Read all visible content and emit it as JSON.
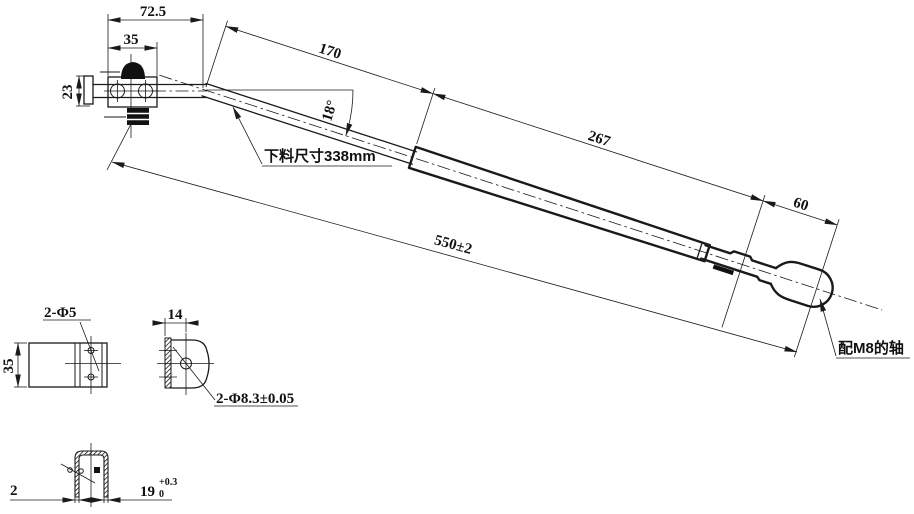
{
  "colors": {
    "background": "#ffffff",
    "line": "#1a1a1a"
  },
  "main_view": {
    "dim_top_width": "72.5",
    "dim_bracket_width": "35",
    "dim_bracket_height": "23",
    "dim_straight_segment": "170",
    "dim_bend_angle": "18°",
    "dim_taper_segment": "267",
    "dim_hook_segment": "60",
    "dim_overall_length": "550±2",
    "note_blank_size": "下料尺寸338mm",
    "note_shaft_fit": "配M8的轴"
  },
  "detail_front": {
    "dim_height": "35",
    "dim_holes": "2-Φ5"
  },
  "detail_side": {
    "dim_width": "14",
    "dim_holes": "2-Φ8.3±0.05"
  },
  "detail_section": {
    "dim_wall_thickness": "2",
    "dim_inner_width": "19",
    "tol_upper": "+0.3",
    "tol_lower": "0"
  }
}
